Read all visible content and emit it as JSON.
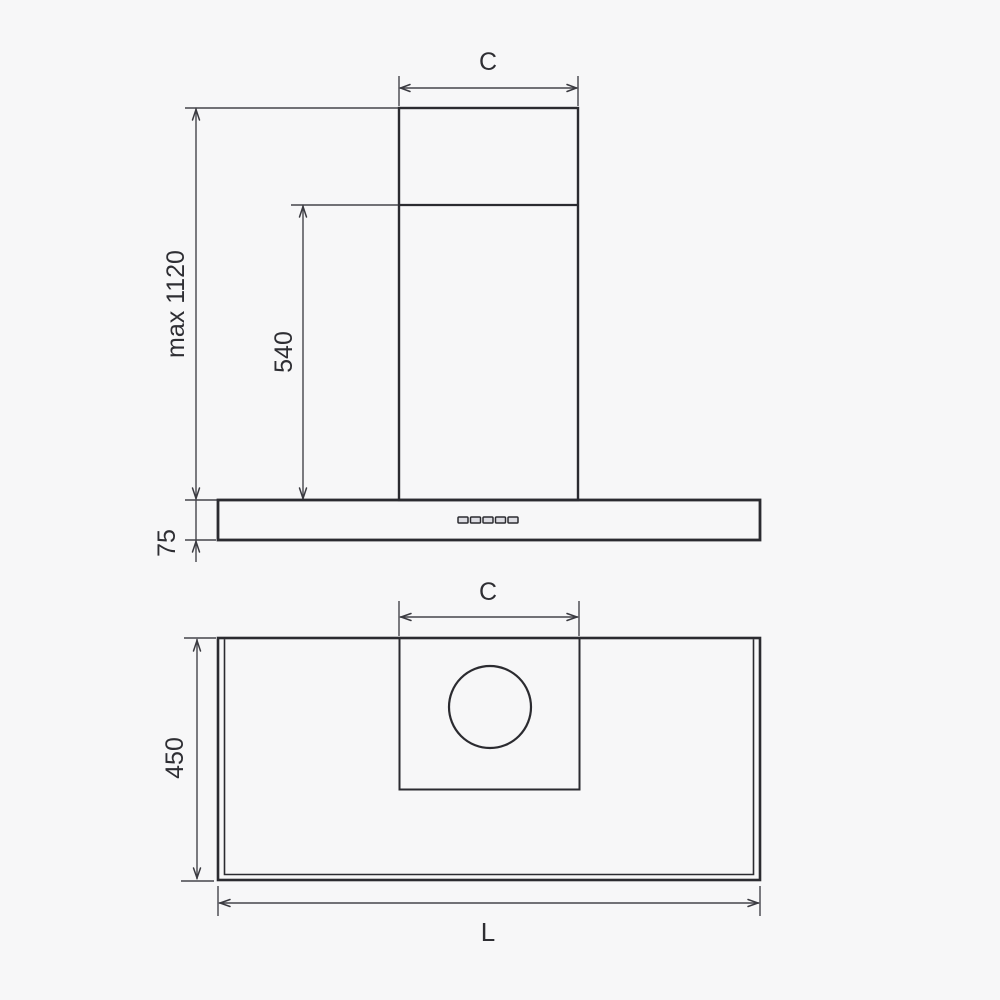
{
  "diagram": {
    "description": "range-hood installation dimension drawing, front elevation and plan view",
    "colors": {
      "background": "#f7f7f8",
      "object_line": "#2b2b30",
      "dimension_line": "#45454b",
      "text": "#2e2e33"
    },
    "front_view": {
      "chimney_width_label": "C",
      "max_height_label": "max 1120",
      "chimney_height_label": "540",
      "body_height_label": "75",
      "control_buttons_count": 5
    },
    "plan_view": {
      "chimney_width_label": "C",
      "depth_label": "450",
      "length_label": "L"
    }
  }
}
